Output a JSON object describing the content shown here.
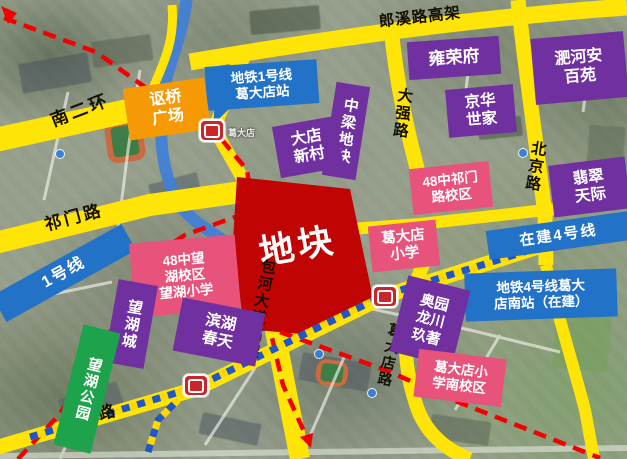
{
  "plot": {
    "label": "地块"
  },
  "roads": {
    "langxi": "郎溪路高架",
    "nanerhuan": "南二环",
    "qimen": "祁门路",
    "daqiang": "大强路",
    "beijing": "北京路",
    "baohe": "包河大道高架",
    "longchuan": "龙川路",
    "gedadian": "葛大店路"
  },
  "metro": {
    "line1_callout": "地铁1号线\n葛大店站",
    "line1_band": "1号线",
    "line4_band": "在建4号线",
    "line4_station": "地铁4号线葛大\n店南站（在建）",
    "station1_name": "葛大店"
  },
  "places": {
    "yongrongfu": "雍荣府",
    "feihe_anbaiyuan": "淝河安\n百苑",
    "jinghua_shijia": "京华\n世家",
    "zhongliang_plot": "中梁地块",
    "dadian_xincun": "大店\n新村",
    "ouqiao_plaza": "讴桥\n广场",
    "feicui_tianji": "翡翠\n天际",
    "school48_qimen": "48中祁门\n路校区",
    "gedadian_school": "葛大店\n小学",
    "school48_wanghu": "48中望\n湖校区\n望湖小学",
    "wanghucheng": "望湖城",
    "wanghu_park": "望湖公园",
    "binhu_chuntian": "滨湖\n春天",
    "aoyuan_longchuan": "奥园\n龙川\n玖著",
    "gedadian_school_south": "葛大店小\n学南校区"
  },
  "colors": {
    "road_yellow": "#FFE408",
    "label_purple": "#7030A0",
    "label_pink": "#E8537B",
    "label_blue": "#2272C8",
    "label_orange": "#F59A05",
    "label_green": "#1FA24C",
    "plot_red": "#C00404",
    "metro_dash_red": "#F20000",
    "expressway_blue": "#407FD8"
  }
}
